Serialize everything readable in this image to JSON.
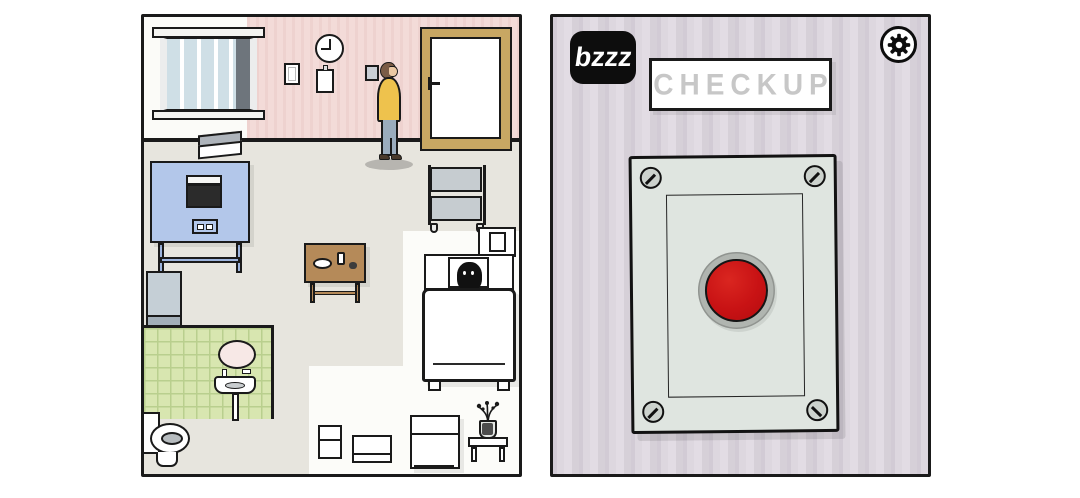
{
  "colors": {
    "button_red": "#c81214",
    "button_ring": "#b0b5b0",
    "panel_metal": "#dfe5e0",
    "wallpaper_right": "#d9d3db",
    "wallpaper_pink": "#f3dbd8",
    "floor": "#e7e5de",
    "tiles_green": "#d8e6b0",
    "sweater_yellow": "#eec24d",
    "machine_blue": "#b3c7ea",
    "table_wood": "#b58a59",
    "door_frame_tan": "#c8a763"
  },
  "left_panel": {
    "clock_time": "9:00"
  },
  "right_panel": {
    "logo_label": "bzzz",
    "sign_label": "CHECKUP",
    "settings_icon": "gear-icon",
    "button_color": "#c81214"
  }
}
